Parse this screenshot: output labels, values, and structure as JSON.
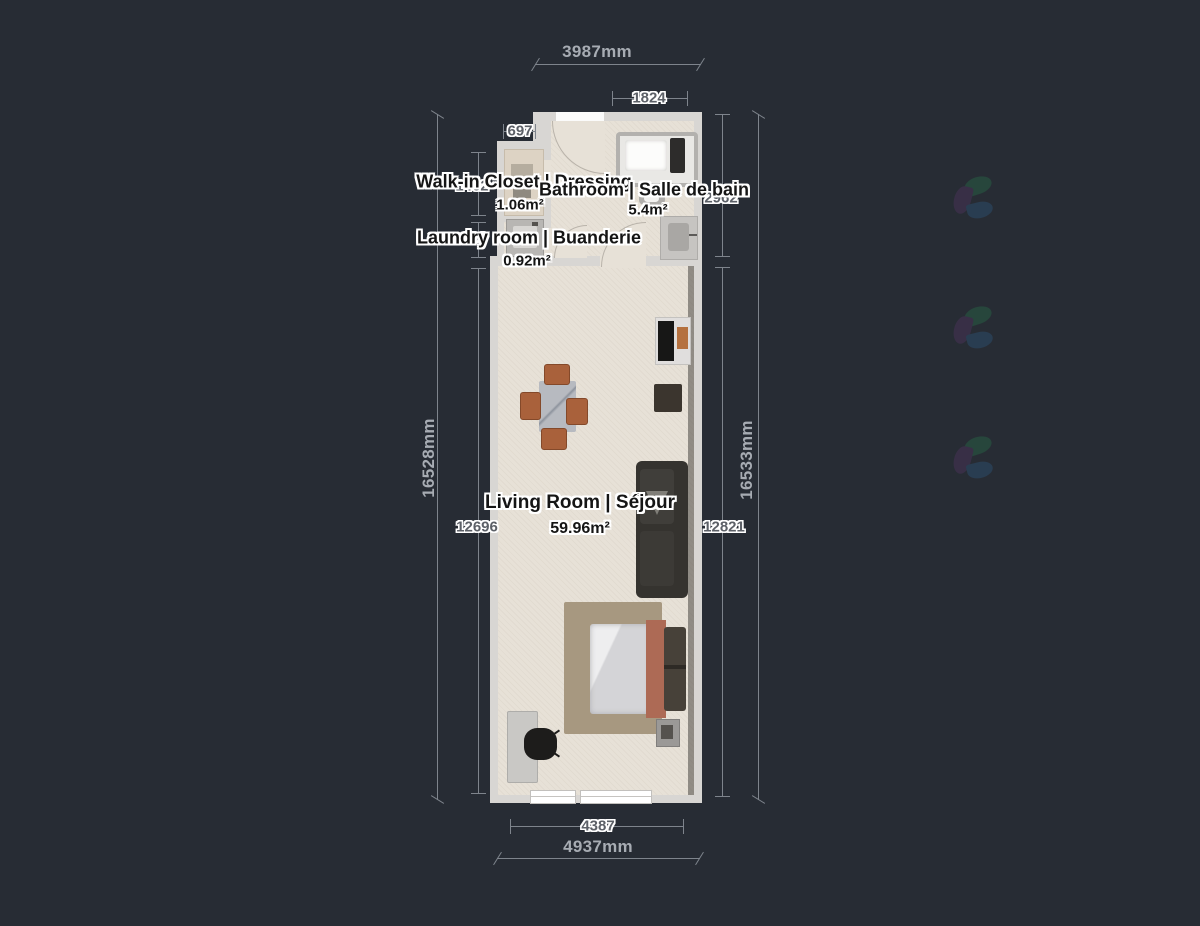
{
  "meta": {
    "description": "Apartment floor plan render with bilingual room labels and millimeter dimension chains",
    "watermark_icon": "leaf-pinwheel-logo"
  },
  "rooms": [
    {
      "name": "Walk-in Closet | Dressing",
      "area": "1.06m²"
    },
    {
      "name": "Bathroom | Salle de bain",
      "area": "5.4m²"
    },
    {
      "name": "Laundry room | Buanderie",
      "area": "0.92m²"
    },
    {
      "name": "Living Room | Séjour",
      "area": "59.96m²"
    }
  ],
  "dimensions": {
    "top_overall": "3987mm",
    "top_bathroom": "1824",
    "top_closet": "697",
    "left_overall": "16528mm",
    "left_closet": "1462",
    "left_laundry": "906",
    "left_living": "12696",
    "right_bathroom": "2962",
    "right_living": "12821",
    "right_overall": "16533mm",
    "bottom_living": "4387",
    "bottom_overall": "4937mm"
  },
  "colors": {
    "background": "#272c34",
    "wall": "#d8d6d3",
    "floor": "#e7e1d7",
    "dimline": "#7e848c",
    "dimtext": "#a7acb3",
    "wood": "#a9613b",
    "terracotta": "#ad6a55",
    "rug": "#a79880",
    "sofa": "#35332f",
    "wmgreen": "#27493d",
    "wmblue": "#2a3f55",
    "wmpurple": "#3a3049"
  }
}
